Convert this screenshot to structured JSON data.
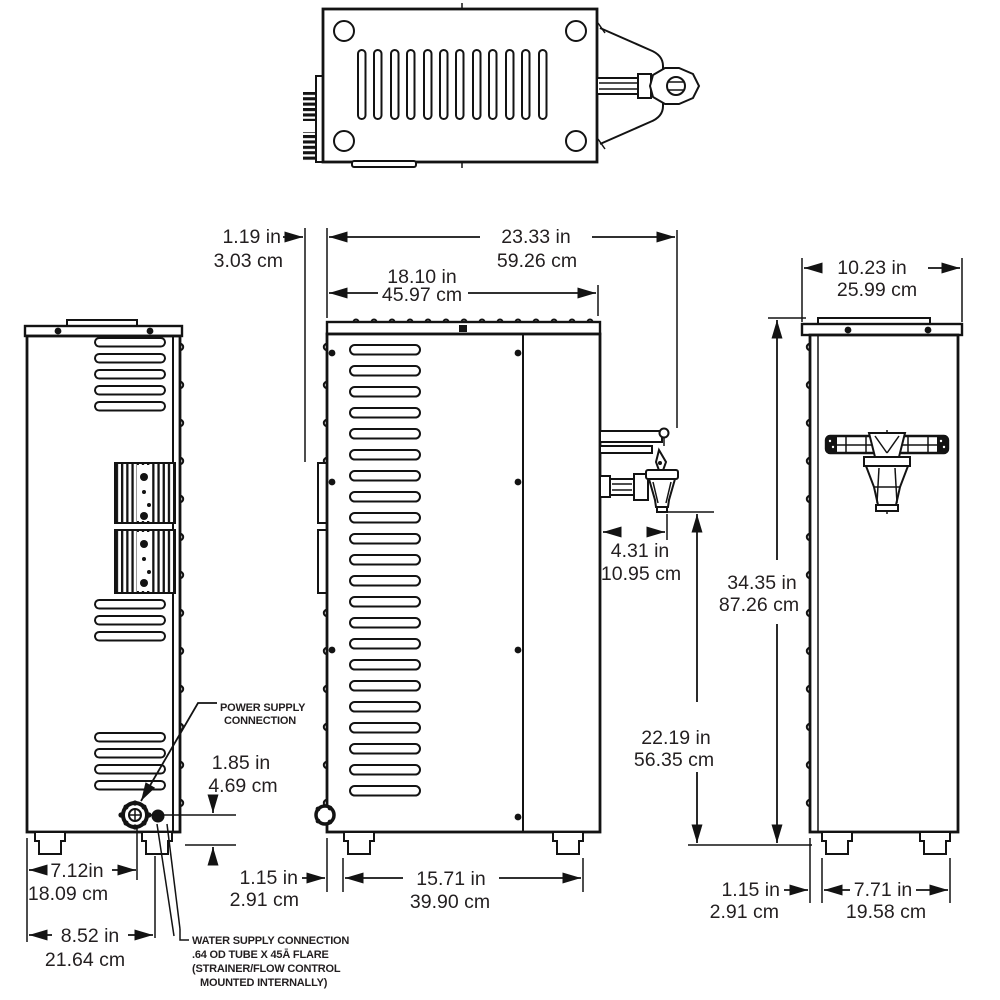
{
  "dims": {
    "top_inset": {
      "in": "1.19 in",
      "cm": "3.03 cm"
    },
    "overall_depth": {
      "in": "23.33 in",
      "cm": "59.26 cm"
    },
    "body_depth": {
      "in": "18.10 in",
      "cm": "45.97 cm"
    },
    "front_width": {
      "in": "10.23 in",
      "cm": "25.99 cm"
    },
    "faucet_reach": {
      "in": "4.31 in",
      "cm": "10.95 cm"
    },
    "overall_height": {
      "in": "34.35 in",
      "cm": "87.26 cm"
    },
    "spout_height": {
      "in": "22.19 in",
      "cm": "56.35 cm"
    },
    "power_conn_height": {
      "in": "1.85 in",
      "cm": "4.69 cm"
    },
    "power_conn_offset": {
      "in": "7.12in",
      "cm": "18.09 cm"
    },
    "water_conn_offset": {
      "in": "8.52 in",
      "cm": "21.64 cm"
    },
    "side_foot_inset": {
      "in": "1.15 in",
      "cm": "2.91 cm"
    },
    "side_foot_span": {
      "in": "15.71 in",
      "cm": "39.90 cm"
    },
    "front_foot_inset": {
      "in": "1.15 in",
      "cm": "2.91 cm"
    },
    "front_foot_span": {
      "in": "7.71 in",
      "cm": "19.58 cm"
    }
  },
  "labels": {
    "power1": "POWER SUPPLY",
    "power2": "CONNECTION",
    "water1": "WATER SUPPLY CONNECTION",
    "water2": ".64 OD TUBE X 45Ā FLARE",
    "water3": "(STRAINER/FLOW CONTROL",
    "water4": "MOUNTED INTERNALLY)"
  }
}
